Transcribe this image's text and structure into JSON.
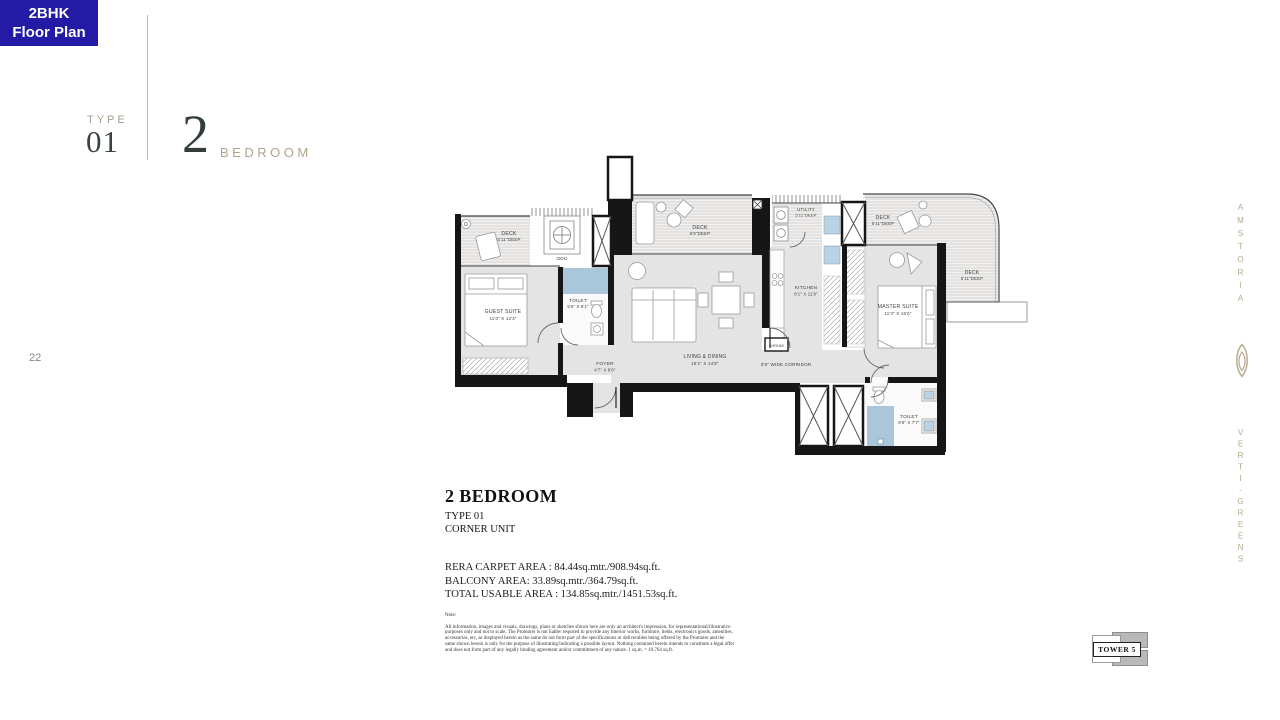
{
  "page": {
    "number": "22"
  },
  "badge": {
    "line1": "2BHK",
    "line2": "Floor Plan",
    "bg_color": "#231ba6",
    "text_color": "#ffffff"
  },
  "header": {
    "type_label": "TYPE",
    "type_number": "01",
    "unit_count": "2",
    "unit_label": "BEDROOM"
  },
  "plan": {
    "rooms": {
      "deck_left": {
        "name": "DECK",
        "dim": "5'11\"DEEP"
      },
      "odu": {
        "name": "ODU"
      },
      "guest_suite": {
        "name": "GUEST SUITE",
        "dim": "11'0\" X 13'3\""
      },
      "guest_toilet": {
        "name": "TOILET",
        "dim": "5'6\" X 8'1\""
      },
      "foyer": {
        "name": "FOYER",
        "dim": "4'7\" X 8'6\""
      },
      "deck_center": {
        "name": "DECK",
        "dim": "6'9\"DEEP"
      },
      "utility": {
        "name": "UTILITY",
        "dim": "5'11\"DEEP"
      },
      "kitchen": {
        "name": "KITCHEN",
        "dim": "8'1\" X 11'9\""
      },
      "living_dining": {
        "name": "LIVING & DINING",
        "dim": "19'1\" X 14'8\""
      },
      "shrine": {
        "name": "SHRINE"
      },
      "corridor": {
        "name": "3'6\" WIDE CORRIDOR"
      },
      "deck_top_right": {
        "name": "DECK",
        "dim": "5'11\"DEEP"
      },
      "deck_right": {
        "name": "DECK",
        "dim": "5'11\"DEEP"
      },
      "master_suite": {
        "name": "MASTER SUITE",
        "dim": "11'0\" X 15'6\""
      },
      "master_toilet": {
        "name": "TOILET",
        "dim": "8'6\" X 7'7\""
      }
    },
    "colors": {
      "wall": "#161616",
      "room_fill": "#e4e4e4",
      "wet_fill": "#a9c6db"
    }
  },
  "details": {
    "title": "2 BEDROOM",
    "subtitle_type": "TYPE 01",
    "subtitle_unit": "CORNER UNIT",
    "area_line1": "RERA CARPET AREA : 84.44sq.mtr./908.94sq.ft.",
    "area_line2": "BALCONY AREA: 33.89sq.mtr./364.79sq.ft.",
    "area_line3": "TOTAL USABLE AREA : 134.85sq.mtr./1451.53sq.ft.",
    "note_label": "Note:",
    "note_body": "All information, images and visuals, drawings, plans or sketches shown here are only an architect's impression, for representational/illustrative purposes only and not to scale. The Promoter is not liable/ required to provide any Interior works, furniture, items, electronics goods, amenities, accessories, etc, as displayed herein as the same do not form part of the specifications or deliverables being offered by the Promoter and the same shown herein is only for the purpose of illustrating/indicating a possible layout. Nothing contained herein intends to constitute a legal offer and does not form part of any legally binding agreement and/or commitment of any nature. 1 sq.m. = 10.764 sq.ft."
  },
  "keyplan": {
    "label": "TOWER 5"
  },
  "brand": {
    "top": "AMSTORIA",
    "bottom": "VERTI-GREENS",
    "color": "#b5a78c"
  }
}
